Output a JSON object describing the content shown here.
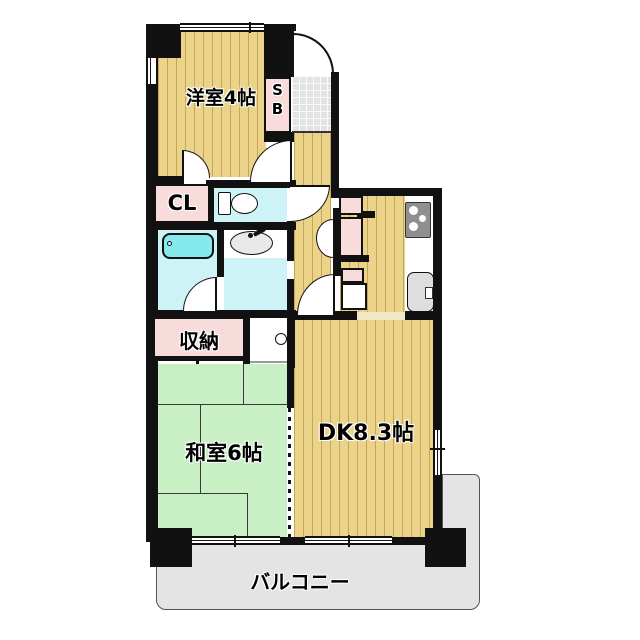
{
  "title": "apartment-floor-plan",
  "labels": {
    "western_room": "洋室4帖",
    "japanese_room": "和室6帖",
    "dining_kitchen": "DK8.3帖",
    "balcony": "バルコニー",
    "closet": "CL",
    "storage": "収納",
    "shoebox_line1": "S",
    "shoebox_line2": "B"
  },
  "fixtures": {
    "bathtub": "bathtub",
    "toilet": "toilet",
    "washbasin": "washbasin",
    "stove": "gas-stove",
    "kitchen_sink": "kitchen-sink",
    "washing_machine": "washing-machine-drain",
    "refrigerator": "refrigerator-space",
    "entrance": "entrance-door"
  },
  "colors": {
    "wall": "#111111",
    "wood_floor": "#ecd38a",
    "tatami": "#c9f0c4",
    "closet_pink": "#f8dbdb",
    "water_room_cyan": "#cdf3f6",
    "fixture_cyan": "#86e9ee",
    "balcony_gray": "#e4e4e4",
    "entrance_tile": "#e3e3e3"
  }
}
